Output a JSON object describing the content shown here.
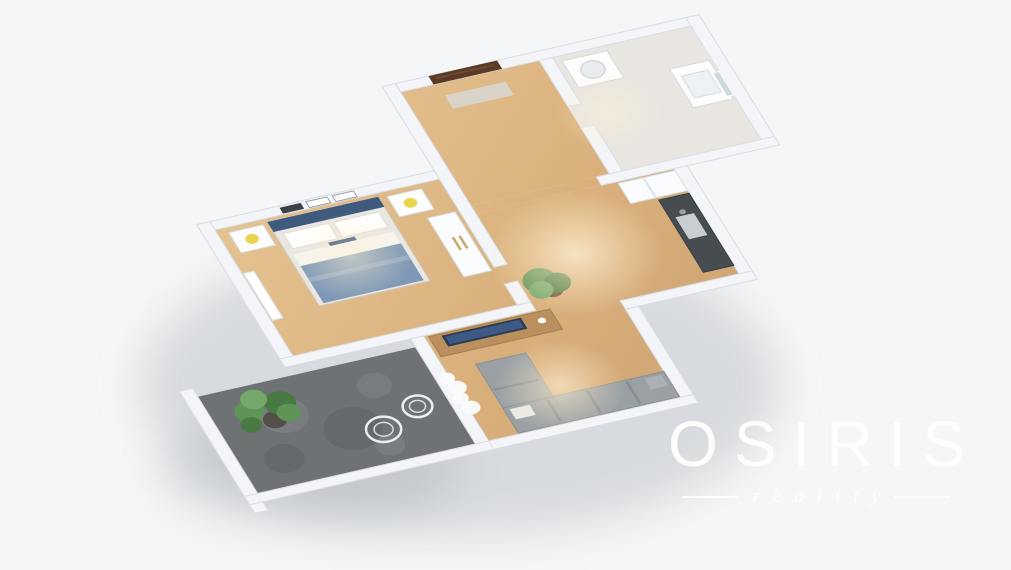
{
  "watermark": {
    "title": "OSIRIS",
    "subtitle": "reality"
  },
  "palette": {
    "background": "#f5f6f7",
    "wall": "#f3f5f8",
    "wallEdge": "#d9dee4",
    "wood": "#dcb584",
    "woodHall": "#d3aa78",
    "tile": "#e9e6e1",
    "stone": "#6f7274",
    "stoneLight": "#83868a",
    "stoneDark": "#5c5f62",
    "sofa": "#9aa0a4",
    "sofaLight": "#abb0b4",
    "bedHead": "#3e5a7c",
    "bedNavy": "#2f4e78",
    "bedBlanket": "#7e98b6",
    "plantGreen": "#5f9457",
    "plantDark": "#497a44",
    "doorBrown": "#5a3a26",
    "counter": "#474c51",
    "lampYellow": "#e8d44d",
    "gold": "#c9a86a",
    "logo": "#ffffff"
  },
  "floorplan": {
    "rooms": [
      {
        "name": "bedroom-floor",
        "floor": "wood",
        "rect": [
          0,
          0,
          170,
          150
        ]
      },
      {
        "name": "hallway-floor",
        "floor": "wood",
        "rect": [
          180,
          -100,
          105,
          135
        ]
      },
      {
        "name": "hallway-opening-floor",
        "floor": "wood",
        "rect": [
          180,
          35,
          95,
          10
        ]
      },
      {
        "name": "bedroom-door-floor",
        "floor": "wood",
        "rect": [
          170,
          105,
          10,
          20
        ]
      },
      {
        "name": "bathroom-floor",
        "floor": "tile",
        "rect": [
          295,
          -100,
          105,
          135
        ]
      },
      {
        "name": "bathroom-door-floor",
        "floor": "tile",
        "rect": [
          285,
          -45,
          10,
          25
        ]
      },
      {
        "name": "living-kitchen-floor",
        "floor": "wood",
        "poly": [
          [
            95,
            160
          ],
          [
            180,
            160
          ],
          [
            180,
            45
          ],
          [
            330,
            45
          ],
          [
            330,
            170
          ],
          [
            240,
            170
          ],
          [
            240,
            285
          ],
          [
            95,
            285
          ]
        ]
      },
      {
        "name": "balcony-floor",
        "floor": "stone",
        "rect": [
          -80,
          170,
          165,
          115
        ]
      }
    ],
    "walls": [
      {
        "name": "wall-bedroom-north",
        "rect": [
          -10,
          -10,
          180,
          10
        ]
      },
      {
        "name": "wall-bedroom-west",
        "rect": [
          -10,
          -10,
          10,
          170
        ]
      },
      {
        "name": "wall-bedroom-south",
        "rect": [
          -10,
          150,
          190,
          10
        ]
      },
      {
        "name": "wall-bedroom-east",
        "rect": [
          170,
          -110,
          10,
          215
        ]
      },
      {
        "name": "wall-bedroom-east-2",
        "rect": [
          170,
          125,
          10,
          25
        ]
      },
      {
        "name": "wall-entry-north",
        "rect": [
          180,
          -110,
          230,
          10
        ]
      },
      {
        "name": "wall-hall-bath-divider",
        "rect": [
          285,
          -100,
          10,
          55
        ]
      },
      {
        "name": "wall-hall-bath-divider-2",
        "rect": [
          285,
          -20,
          10,
          55
        ]
      },
      {
        "name": "wall-bathroom-east",
        "rect": [
          400,
          -110,
          10,
          155
        ]
      },
      {
        "name": "wall-bathroom-south",
        "rect": [
          275,
          35,
          135,
          10
        ]
      },
      {
        "name": "wall-kitchen-east",
        "rect": [
          330,
          45,
          10,
          135
        ]
      },
      {
        "name": "wall-kitchen-south",
        "rect": [
          240,
          170,
          100,
          10
        ]
      },
      {
        "name": "wall-living-east",
        "rect": [
          240,
          180,
          10,
          105
        ]
      },
      {
        "name": "wall-living-south",
        "rect": [
          85,
          285,
          165,
          10
        ]
      },
      {
        "name": "wall-living-west",
        "rect": [
          85,
          160,
          10,
          125
        ]
      },
      {
        "name": "wall-balcony-west",
        "rect": [
          -90,
          160,
          10,
          145
        ]
      },
      {
        "name": "wall-balcony-south",
        "rect": [
          -90,
          285,
          185,
          10
        ]
      }
    ],
    "items": [
      {
        "name": "bedroom-radiator",
        "shape": "rect",
        "fill": "#ffffff",
        "stroke": "#d8dde2",
        "rect": [
          1,
          52,
          8,
          56
        ]
      },
      {
        "name": "bed-frame",
        "shape": "rect",
        "fill": "#e9e7e2",
        "stroke": "#cfc9bf",
        "rect": [
          38,
          4,
          84,
          100
        ]
      },
      {
        "name": "bed-headboard",
        "shape": "rect",
        "fill": "bedHead",
        "rect": [
          38,
          4,
          84,
          12
        ]
      },
      {
        "name": "bed-pillow-left",
        "shape": "rect",
        "fill": "#ffffff",
        "stroke": "#e0ddd6",
        "rect": [
          44,
          20,
          34,
          18
        ]
      },
      {
        "name": "bed-pillow-right",
        "shape": "rect",
        "fill": "#ffffff",
        "stroke": "#e0ddd6",
        "rect": [
          82,
          20,
          34,
          18
        ]
      },
      {
        "name": "bed-decor-pillow",
        "shape": "rect",
        "fill": "bedNavy",
        "rect": [
          70,
          40,
          20,
          13
        ]
      },
      {
        "name": "bed-sheet",
        "shape": "rect",
        "fill": "#f6f5f1",
        "rect": [
          42,
          44,
          76,
          14
        ]
      },
      {
        "name": "bed-blanket",
        "shape": "rect",
        "fill": "bedBlanket",
        "rect": [
          42,
          58,
          76,
          44
        ]
      },
      {
        "name": "bed-blanket-fold",
        "shape": "rect",
        "fill": "#93a9c4",
        "rect": [
          42,
          72,
          76,
          5
        ]
      },
      {
        "name": "nightstand-left",
        "shape": "rect",
        "fill": "#fdfdfd",
        "stroke": "#d8dde2",
        "rect": [
          8,
          6,
          26,
          24
        ]
      },
      {
        "name": "nightstand-lamp-left",
        "shape": "circle",
        "fill": "lampYellow",
        "c": [
          21,
          18
        ],
        "r": 5
      },
      {
        "name": "nightstand-right",
        "shape": "rect",
        "fill": "#fdfdfd",
        "stroke": "#d8dde2",
        "rect": [
          128,
          6,
          26,
          24
        ]
      },
      {
        "name": "nightstand-lamp-right",
        "shape": "circle",
        "fill": "lampYellow",
        "c": [
          141,
          18
        ],
        "r": 5
      },
      {
        "name": "wall-frame-dark",
        "shape": "rect",
        "fill": "#3c4148",
        "rect": [
          52,
          -8,
          16,
          7
        ]
      },
      {
        "name": "wall-frame-mid",
        "shape": "rect",
        "fill": "#fdfdfd",
        "stroke": "#9aa0a6",
        "rect": [
          72,
          -8,
          16,
          7
        ]
      },
      {
        "name": "wall-frame-right",
        "shape": "rect",
        "fill": "#fdfdfd",
        "stroke": "#9aa0a6",
        "rect": [
          92,
          -8,
          16,
          7
        ]
      },
      {
        "name": "wardrobe",
        "shape": "rect",
        "fill": "#fbfcfd",
        "stroke": "#d5dade",
        "rect": [
          146,
          38,
          21,
          70
        ]
      },
      {
        "name": "wardrobe-handle",
        "shape": "rect",
        "fill": "gold",
        "rect": [
          154,
          64,
          2,
          15
        ]
      },
      {
        "name": "wardrobe-handle",
        "shape": "rect",
        "fill": "gold",
        "rect": [
          159,
          64,
          2,
          15
        ]
      },
      {
        "name": "tv-cabinet",
        "shape": "rect",
        "fill": "#b9905e",
        "stroke": "#a67e4f",
        "rect": [
          98,
          162,
          92,
          24
        ]
      },
      {
        "name": "tv",
        "shape": "rect",
        "fill": "#2b3b52",
        "rect": [
          107,
          164,
          60,
          13
        ]
      },
      {
        "name": "tv-screen",
        "shape": "rect",
        "fill": "#3c5a85",
        "rect": [
          109,
          166,
          56,
          9
        ]
      },
      {
        "name": "cabinet-decor",
        "shape": "circle",
        "fill": "#ffffff",
        "c": [
          180,
          172
        ],
        "r": 3
      },
      {
        "name": "living-plant-pot",
        "shape": "circle",
        "fill": "#6b5136",
        "c": [
          200,
          142
        ],
        "r": 8
      },
      {
        "name": "living-plant-leaves",
        "shape": "circle",
        "fill": "plantGreen",
        "c": [
          195,
          130
        ],
        "r": 13
      },
      {
        "name": "living-plant-leaves",
        "shape": "circle",
        "fill": "plantDark",
        "c": [
          206,
          136
        ],
        "r": 10
      },
      {
        "name": "living-plant-leaves",
        "shape": "circle",
        "fill": "#74a86b",
        "c": [
          192,
          140
        ],
        "r": 9
      },
      {
        "name": "sofa-chaise",
        "shape": "rect",
        "fill": "sofa",
        "stroke": "#888e93",
        "rect": [
          118,
          202,
          38,
          56
        ]
      },
      {
        "name": "sofa-long-section",
        "shape": "rect",
        "fill": "sofa",
        "stroke": "#888e93",
        "rect": [
          118,
          254,
          122,
          30
        ]
      },
      {
        "name": "sofa-cushion-line",
        "shape": "rect",
        "fill": "#878d92",
        "rect": [
          150,
          256,
          2,
          26
        ]
      },
      {
        "name": "sofa-cushion-line",
        "shape": "rect",
        "fill": "#878d92",
        "rect": [
          180,
          256,
          2,
          26
        ]
      },
      {
        "name": "sofa-cushion-line",
        "shape": "rect",
        "fill": "#878d92",
        "rect": [
          210,
          256,
          2,
          26
        ]
      },
      {
        "name": "sofa-cushion-line",
        "shape": "rect",
        "fill": "#878d92",
        "rect": [
          120,
          232,
          34,
          2
        ]
      },
      {
        "name": "sofa-pillow",
        "shape": "rect",
        "fill": "#e9e9e7",
        "rect": [
          122,
          257,
          15,
          12
        ]
      },
      {
        "name": "sofa-pillow",
        "shape": "rect",
        "fill": "sofaLight",
        "rect": [
          224,
          257,
          13,
          13
        ]
      },
      {
        "name": "kitchen-cabinets",
        "shape": "rect",
        "fill": "#fbfcfd",
        "stroke": "#dde1e6",
        "rect": [
          287,
          47,
          43,
          24
        ]
      },
      {
        "name": "kitchen-cabinet-line",
        "shape": "rect",
        "fill": "#e3e7ec",
        "rect": [
          305,
          47,
          2,
          24
        ]
      },
      {
        "name": "kitchen-counter",
        "shape": "rect",
        "fill": "counter",
        "stroke": "#3a3f44",
        "rect": [
          307,
          74,
          23,
          86
        ]
      },
      {
        "name": "kitchen-sink",
        "shape": "rect",
        "fill": "#c9ced3",
        "rect": [
          311,
          96,
          14,
          26
        ]
      },
      {
        "name": "kitchen-faucet",
        "shape": "circle",
        "fill": "#9aa1a8",
        "c": [
          318,
          92
        ],
        "r": 2.5
      },
      {
        "name": "entrance-door",
        "shape": "rect",
        "fill": "doorBrown",
        "rect": [
          205,
          -110,
          52,
          10
        ]
      },
      {
        "name": "entrance-door-panel",
        "shape": "rect",
        "fill": "#6e4a31",
        "rect": [
          209,
          -107,
          44,
          2
        ]
      },
      {
        "name": "doormat",
        "shape": "rect",
        "fill": "#d9d3c9",
        "rect": [
          208,
          -86,
          46,
          16
        ]
      },
      {
        "name": "washing-machine",
        "shape": "rect",
        "fill": "#fdfdfd",
        "stroke": "#d5dade",
        "rect": [
          300,
          -94,
          34,
          32
        ]
      },
      {
        "name": "washing-machine-door",
        "shape": "circle",
        "fill": "#e8ecef",
        "stroke": "#c6ccd2",
        "c": [
          317,
          -78
        ],
        "r": 9
      },
      {
        "name": "bathroom-vanity",
        "shape": "rect",
        "fill": "#fdfdfd",
        "stroke": "#d5dade",
        "rect": [
          368,
          -60,
          30,
          46
        ]
      },
      {
        "name": "bathroom-basin",
        "shape": "rect",
        "fill": "#eef1f3",
        "stroke": "#d5dade",
        "rect": [
          373,
          -50,
          20,
          26
        ]
      },
      {
        "name": "bathroom-mirror",
        "shape": "rect",
        "fill": "#cfdade",
        "stroke": "#ffffff",
        "rect": [
          395,
          -46,
          5,
          28
        ]
      },
      {
        "name": "balcony-stone-patch",
        "shape": "circle",
        "fill": "stoneLight",
        "opacity": 0.55,
        "c": [
          -30,
          210
        ],
        "r": 18
      },
      {
        "name": "balcony-stone-patch",
        "shape": "circle",
        "fill": "stoneDark",
        "opacity": 0.5,
        "c": [
          10,
          240
        ],
        "r": 22
      },
      {
        "name": "balcony-stone-patch",
        "shape": "circle",
        "fill": "stoneLight",
        "opacity": 0.5,
        "c": [
          42,
          200
        ],
        "r": 13
      },
      {
        "name": "balcony-stone-patch",
        "shape": "circle",
        "fill": "stoneDark",
        "opacity": 0.45,
        "c": [
          -48,
          255
        ],
        "r": 15
      },
      {
        "name": "balcony-stone-patch",
        "shape": "circle",
        "fill": "stoneLight",
        "opacity": 0.5,
        "c": [
          28,
          266
        ],
        "r": 11
      },
      {
        "name": "palm-pot",
        "shape": "circle",
        "fill": "#534e47",
        "c": [
          -38,
          212
        ],
        "r": 9
      },
      {
        "name": "palm-frond",
        "shape": "circle",
        "fill": "plantGreen",
        "c": [
          -52,
          198
        ],
        "r": 11
      },
      {
        "name": "palm-frond",
        "shape": "circle",
        "fill": "plantDark",
        "c": [
          -28,
          196
        ],
        "r": 12
      },
      {
        "name": "palm-frond",
        "shape": "circle",
        "fill": "#74a86b",
        "c": [
          -44,
          186
        ],
        "r": 10
      },
      {
        "name": "palm-frond",
        "shape": "circle",
        "fill": "plantGreen",
        "c": [
          -26,
          208
        ],
        "r": 9
      },
      {
        "name": "palm-frond",
        "shape": "circle",
        "fill": "plantDark",
        "c": [
          -56,
          212
        ],
        "r": 8
      },
      {
        "name": "balcony-chair",
        "shape": "circle",
        "fill": "none",
        "stroke": "#eceeef",
        "strokeWidth": 2.5,
        "c": [
          30,
          248
        ],
        "r": 13
      },
      {
        "name": "balcony-chair-seat",
        "shape": "circle",
        "fill": "none",
        "stroke": "#dadde0",
        "strokeWidth": 1.5,
        "c": [
          30,
          248
        ],
        "r": 7
      },
      {
        "name": "balcony-chair",
        "shape": "circle",
        "fill": "none",
        "stroke": "#eceeef",
        "strokeWidth": 2.5,
        "c": [
          62,
          232
        ],
        "r": 11
      },
      {
        "name": "balcony-chair-seat",
        "shape": "circle",
        "fill": "none",
        "stroke": "#dadde0",
        "strokeWidth": 1.5,
        "c": [
          62,
          232
        ],
        "r": 6
      },
      {
        "name": "balcony-curtain",
        "shape": "circle",
        "fill": "#fafbfc",
        "opacity": 0.97,
        "c": [
          93,
          210
        ],
        "r": 6
      },
      {
        "name": "balcony-curtain",
        "shape": "circle",
        "fill": "#fafbfc",
        "opacity": 0.97,
        "c": [
          96,
          222
        ],
        "r": 7
      },
      {
        "name": "balcony-curtain",
        "shape": "circle",
        "fill": "#fafbfc",
        "opacity": 0.97,
        "c": [
          94,
          234
        ],
        "r": 6
      },
      {
        "name": "balcony-curtain",
        "shape": "circle",
        "fill": "#fafbfc",
        "opacity": 0.97,
        "c": [
          97,
          246
        ],
        "r": 7
      },
      {
        "name": "floor-light-pool",
        "shape": "circle",
        "fill": "url:lightPool",
        "opacity": 0.9,
        "c": [
          230,
          110
        ],
        "r": 65
      },
      {
        "name": "floor-light-pool",
        "shape": "circle",
        "fill": "url:lightPool",
        "opacity": 0.75,
        "c": [
          165,
          245
        ],
        "r": 48
      },
      {
        "name": "floor-light-pool",
        "shape": "circle",
        "fill": "url:lightPool",
        "opacity": 0.6,
        "c": [
          80,
          60
        ],
        "r": 45
      },
      {
        "name": "floor-light-pool",
        "shape": "circle",
        "fill": "url:lightPool",
        "opacity": 0.5,
        "c": [
          310,
          -30
        ],
        "r": 40
      }
    ]
  }
}
